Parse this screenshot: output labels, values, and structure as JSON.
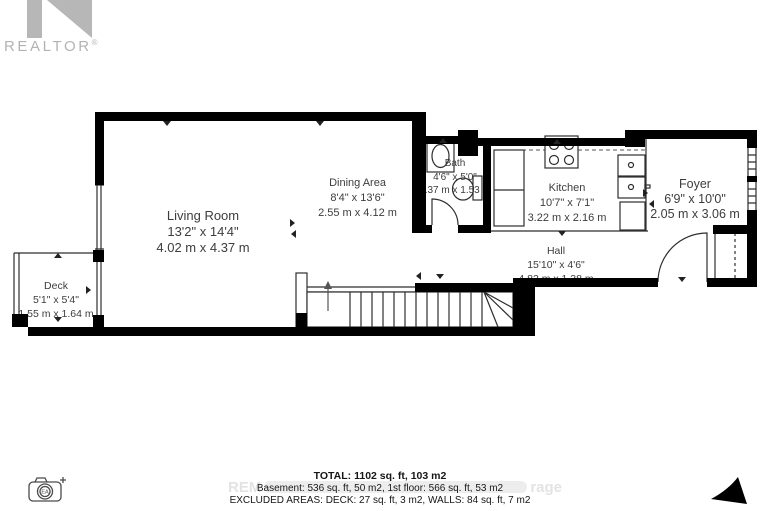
{
  "branding": {
    "logo_text": "REALTOR",
    "registered_mark": "®"
  },
  "rooms": [
    {
      "name": "Living Room",
      "imperial": "13'2\" x 14'4\"",
      "metric": "4.02 m x 4.37 m"
    },
    {
      "name": "Dining Area",
      "imperial": "8'4\" x 13'6\"",
      "metric": "2.55 m x 4.12 m"
    },
    {
      "name": "Bath",
      "imperial": "4'6\" x 5'0\"",
      "metric": "1.37 m x 1.53 m"
    },
    {
      "name": "Kitchen",
      "imperial": "10'7\" x 7'1\"",
      "metric": "3.22 m x 2.16 m"
    },
    {
      "name": "Hall",
      "imperial": "15'10\" x 4'6\"",
      "metric": "4.82 m x 1.38 m"
    },
    {
      "name": "Foyer",
      "imperial": "6'9\" x 10'0\"",
      "metric": "2.05 m x 3.06 m"
    },
    {
      "name": "Deck",
      "imperial": "5'1\" x 5'4\"",
      "metric": "1.55 m x 1.64 m"
    }
  ],
  "summary": {
    "total_line": "TOTAL: 1102 sq. ft, 103 m2",
    "floors_line": "Basement: 536 sq. ft, 50 m2, 1st floor: 566 sq. ft, 53 m2",
    "excluded_line": "EXCLUDED AREAS: DECK: 27 sq. ft, 3 m2, WALLS: 84 sq. ft, 7 m2"
  },
  "watermark": {
    "left_fragment": "REM",
    "right_fragment": "rage"
  },
  "camera_badge": {
    "label": "EA"
  },
  "colors": {
    "wall": "#000000",
    "room_label_text": "#3d3d3d",
    "summary_text": "#161616",
    "logo_gray": "#b3b3b3",
    "watermark_gray": "#e3e3e3"
  }
}
